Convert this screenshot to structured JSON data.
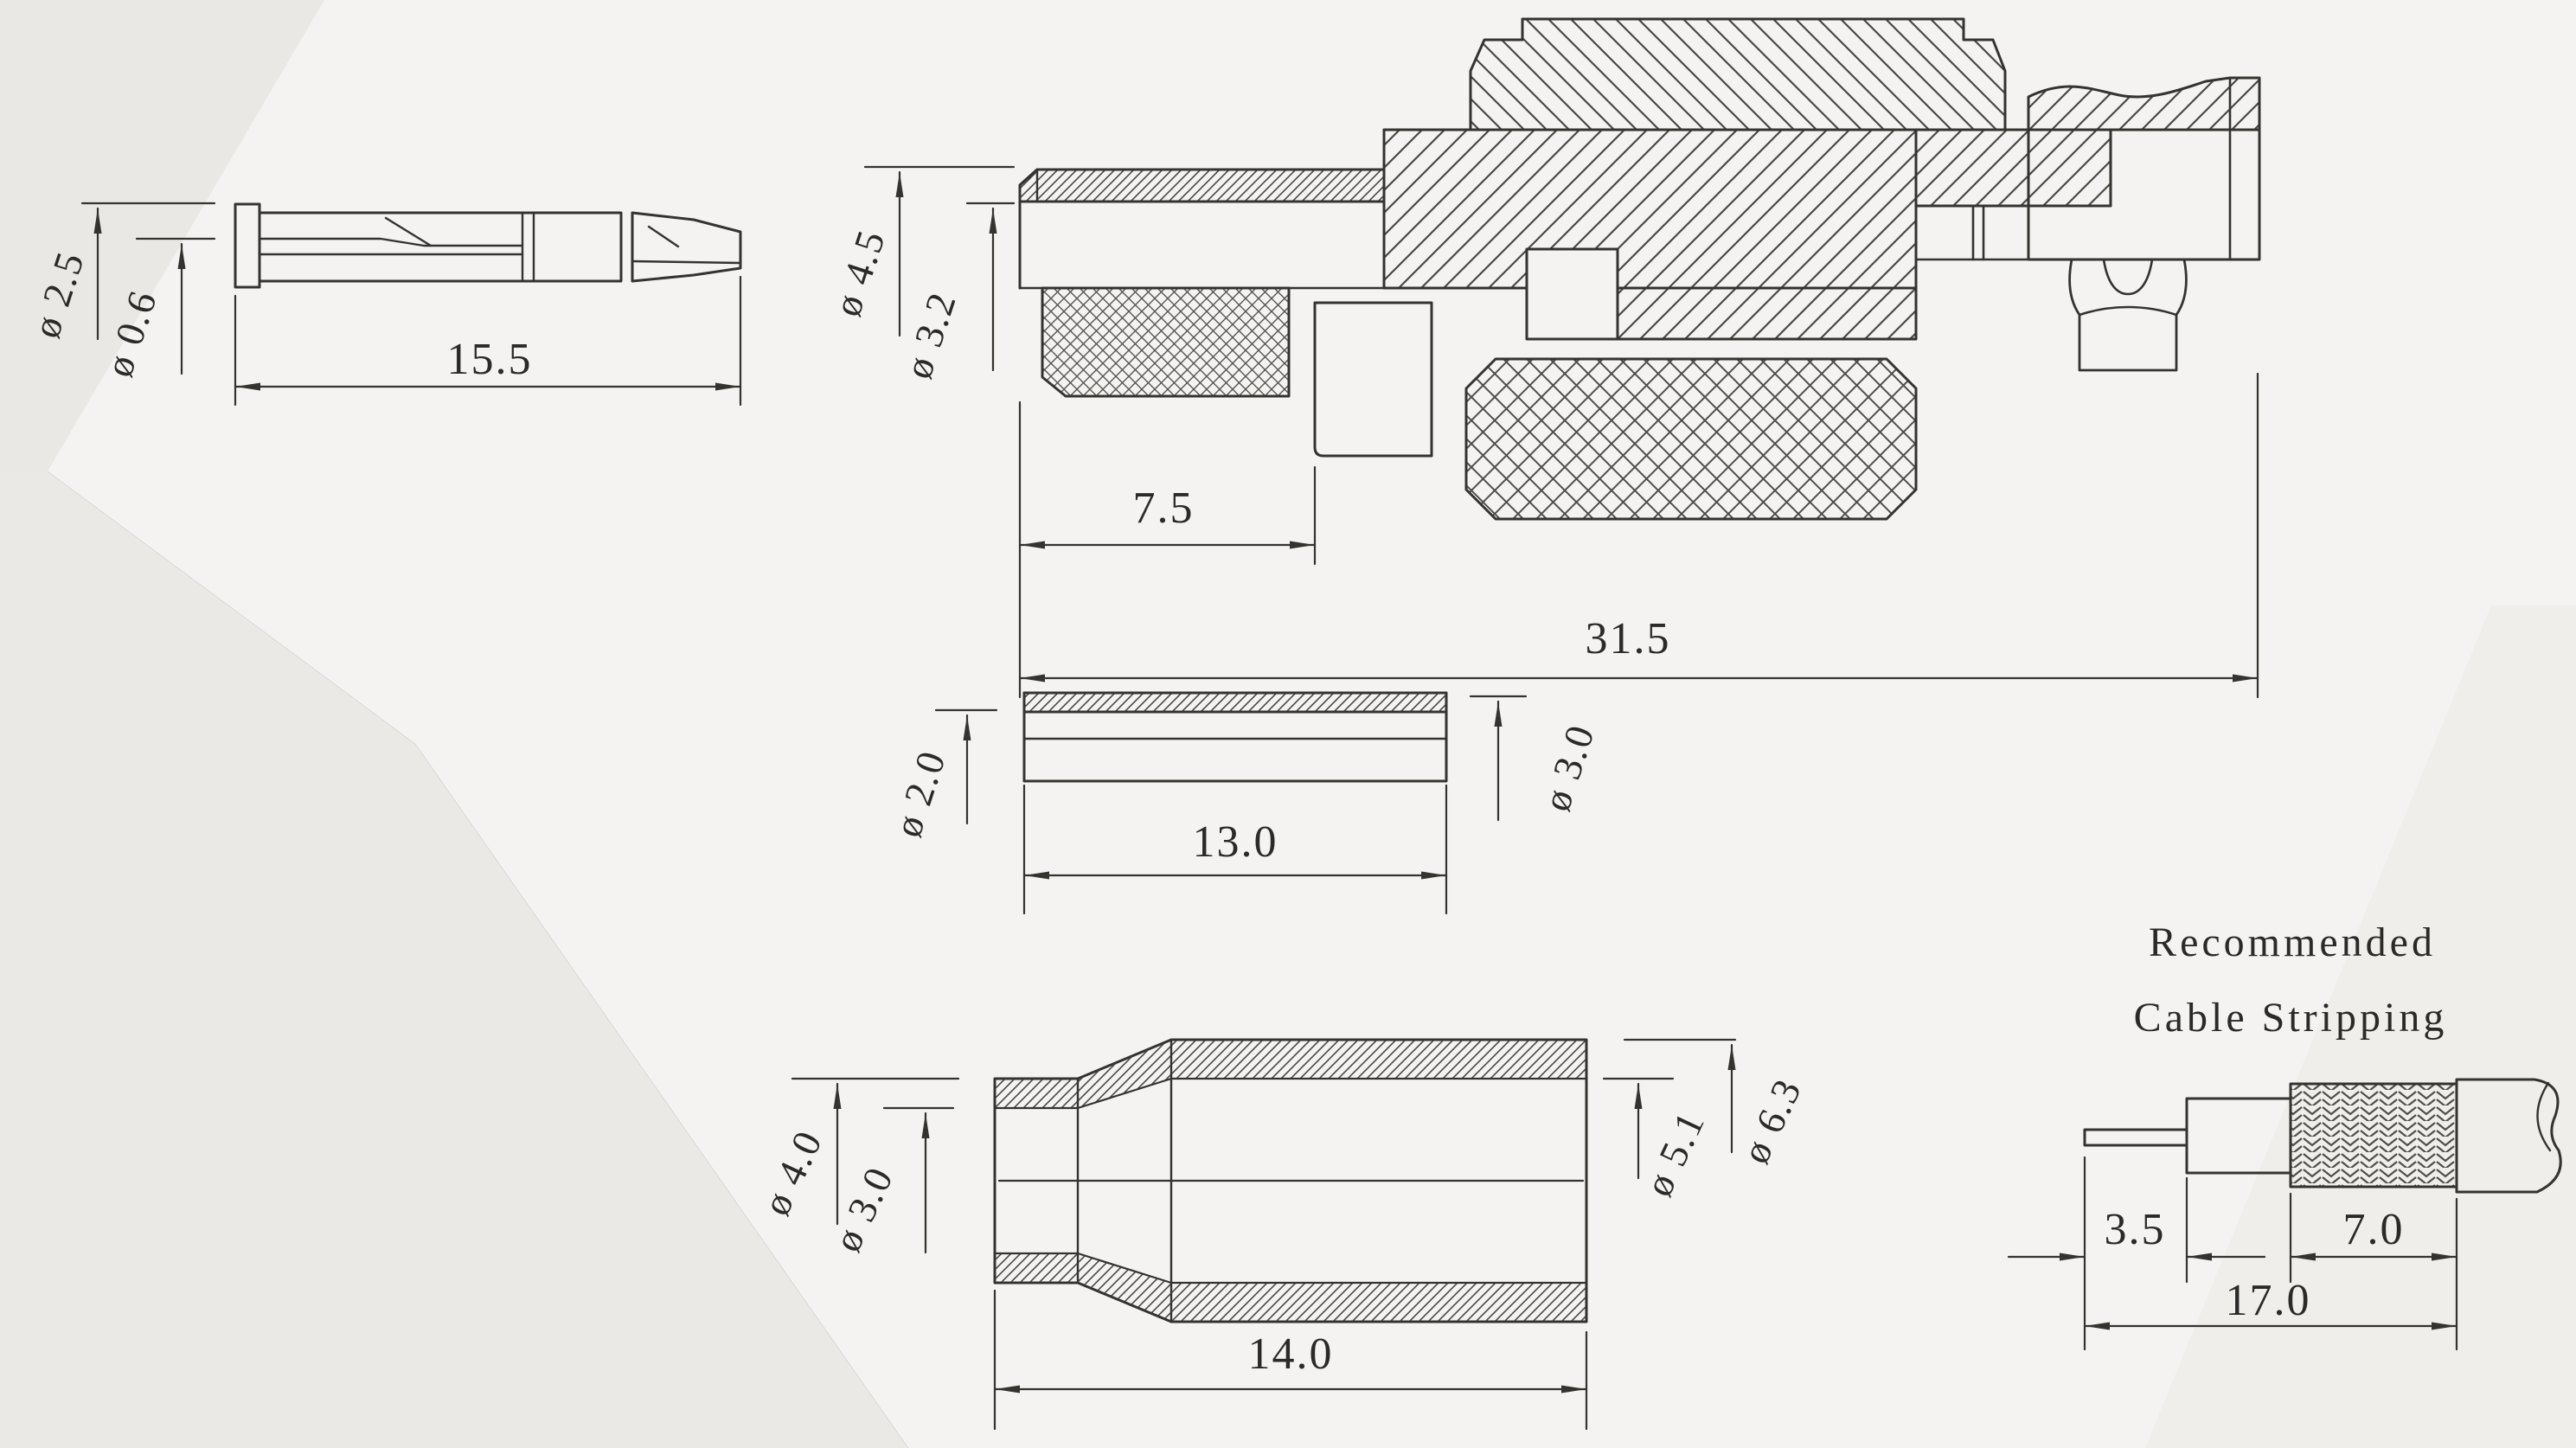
{
  "drawing": {
    "pin": {
      "dia_outer": "ø 2.5",
      "dia_inner": "ø 0.6",
      "length": "15.5"
    },
    "body": {
      "dia_outer": "ø 4.5",
      "dia_inner": "ø 3.2",
      "rear_len": "7.5",
      "total_len": "31.5"
    },
    "ferrule": {
      "dia_inner": "ø 2.0",
      "dia_outer": "ø 3.0",
      "length": "13.0"
    },
    "boot": {
      "dia_outer_small": "ø 4.0",
      "dia_inner_small": "ø 3.0",
      "dia_inner_large": "ø 5.1",
      "dia_outer_large": "ø 6.3",
      "length": "14.0"
    },
    "stripping": {
      "title1": "Recommended",
      "title2": "Cable Stripping",
      "inner": "3.5",
      "braid": "7.0",
      "total": "17.0"
    }
  },
  "colors": {
    "line": "#35332f",
    "paper": "#f4f3f1",
    "paper_shadow": "#e9e8e5",
    "paper_shadow2": "#edece9"
  }
}
